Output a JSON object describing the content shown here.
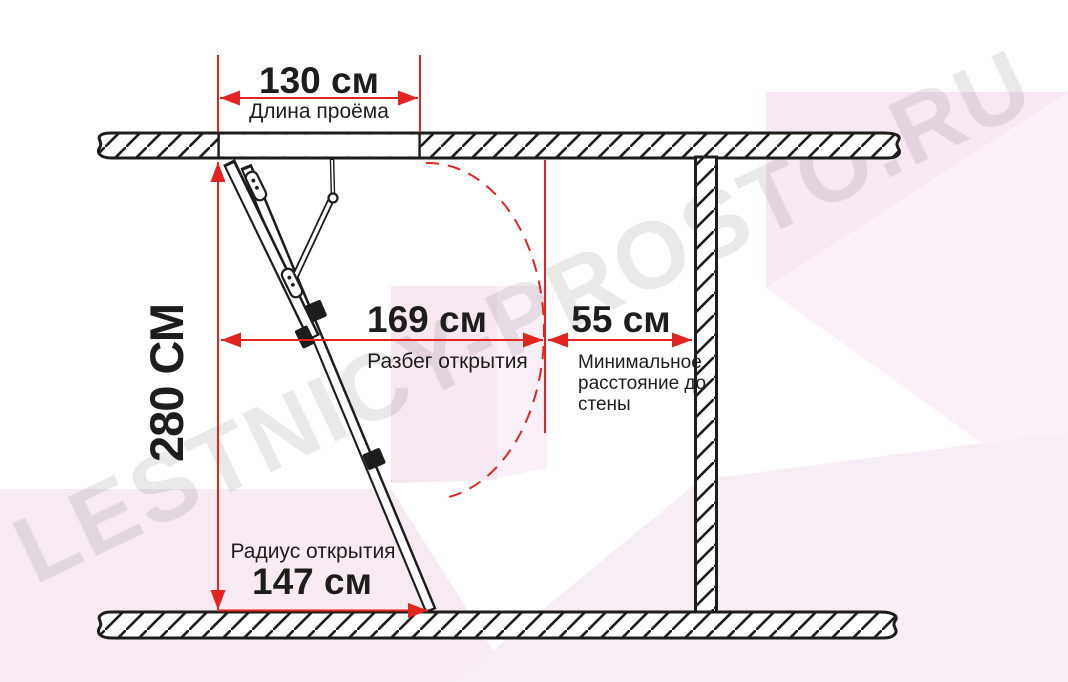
{
  "watermark": "LESTNICY-PROSTO.RU",
  "dimensions": {
    "opening_length": {
      "value": "130 см",
      "label": "Длина проёма"
    },
    "height": {
      "value": "280 СМ"
    },
    "opening_span": {
      "value": "169 см",
      "label": "Разбег открытия"
    },
    "min_wall_distance": {
      "value": "55 см",
      "label": "Минимальное расстояние до стены"
    },
    "opening_radius": {
      "value": "147 см",
      "label": "Радиус открытия"
    }
  },
  "colors": {
    "dimension_red": "#e42420",
    "line_black": "#1d1d1b",
    "text_black": "#1d1d1b",
    "watermark_gray": "rgba(45,40,45,0.10)"
  }
}
